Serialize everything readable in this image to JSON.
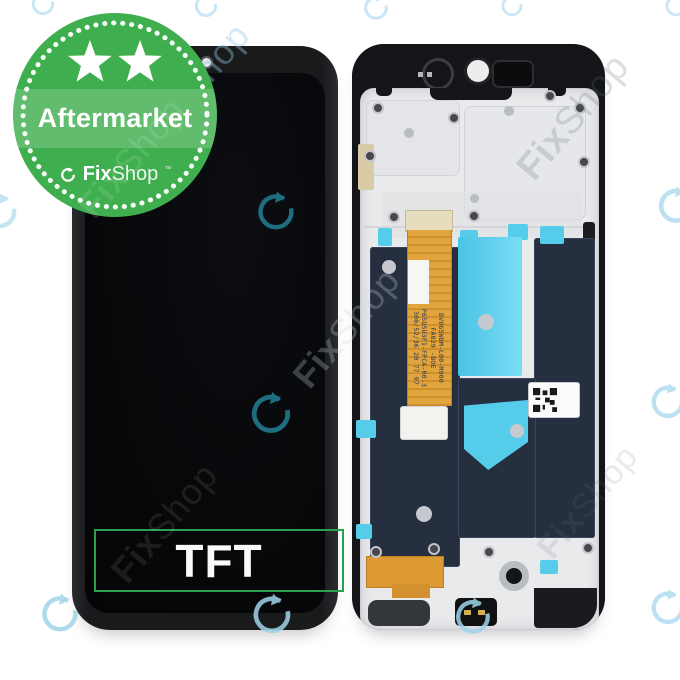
{
  "badge": {
    "label": "Aftermarket",
    "stars_count": "2",
    "brand": {
      "fix": "Fix",
      "shop": "Shop",
      "tm": "™"
    }
  },
  "display": {
    "tft_label": "TFT"
  },
  "flex_cable": {
    "line1": "BV065WBM-L00-M900",
    "line2": "FA029 -BOE",
    "line3": "P65Q5U3F1-FPCA-R0.3",
    "line4": "300/52/36 20 77 97"
  },
  "watermark": {
    "fix": "Fix",
    "shop": "Shop"
  },
  "colors": {
    "badge_green": "#3fae4e",
    "badge_band_green": "#5fbe6e",
    "tft_border_green": "#2aa14f",
    "watermark_blue": "#a6d9ee",
    "watermark_teal": "#1e6e80",
    "adhesive_cyan": "#55cdea",
    "graphite_navy": "#262f40",
    "flex_orange": "#dd9a33",
    "frame_black": "#141518",
    "plate_silver": "#e9eaec"
  }
}
